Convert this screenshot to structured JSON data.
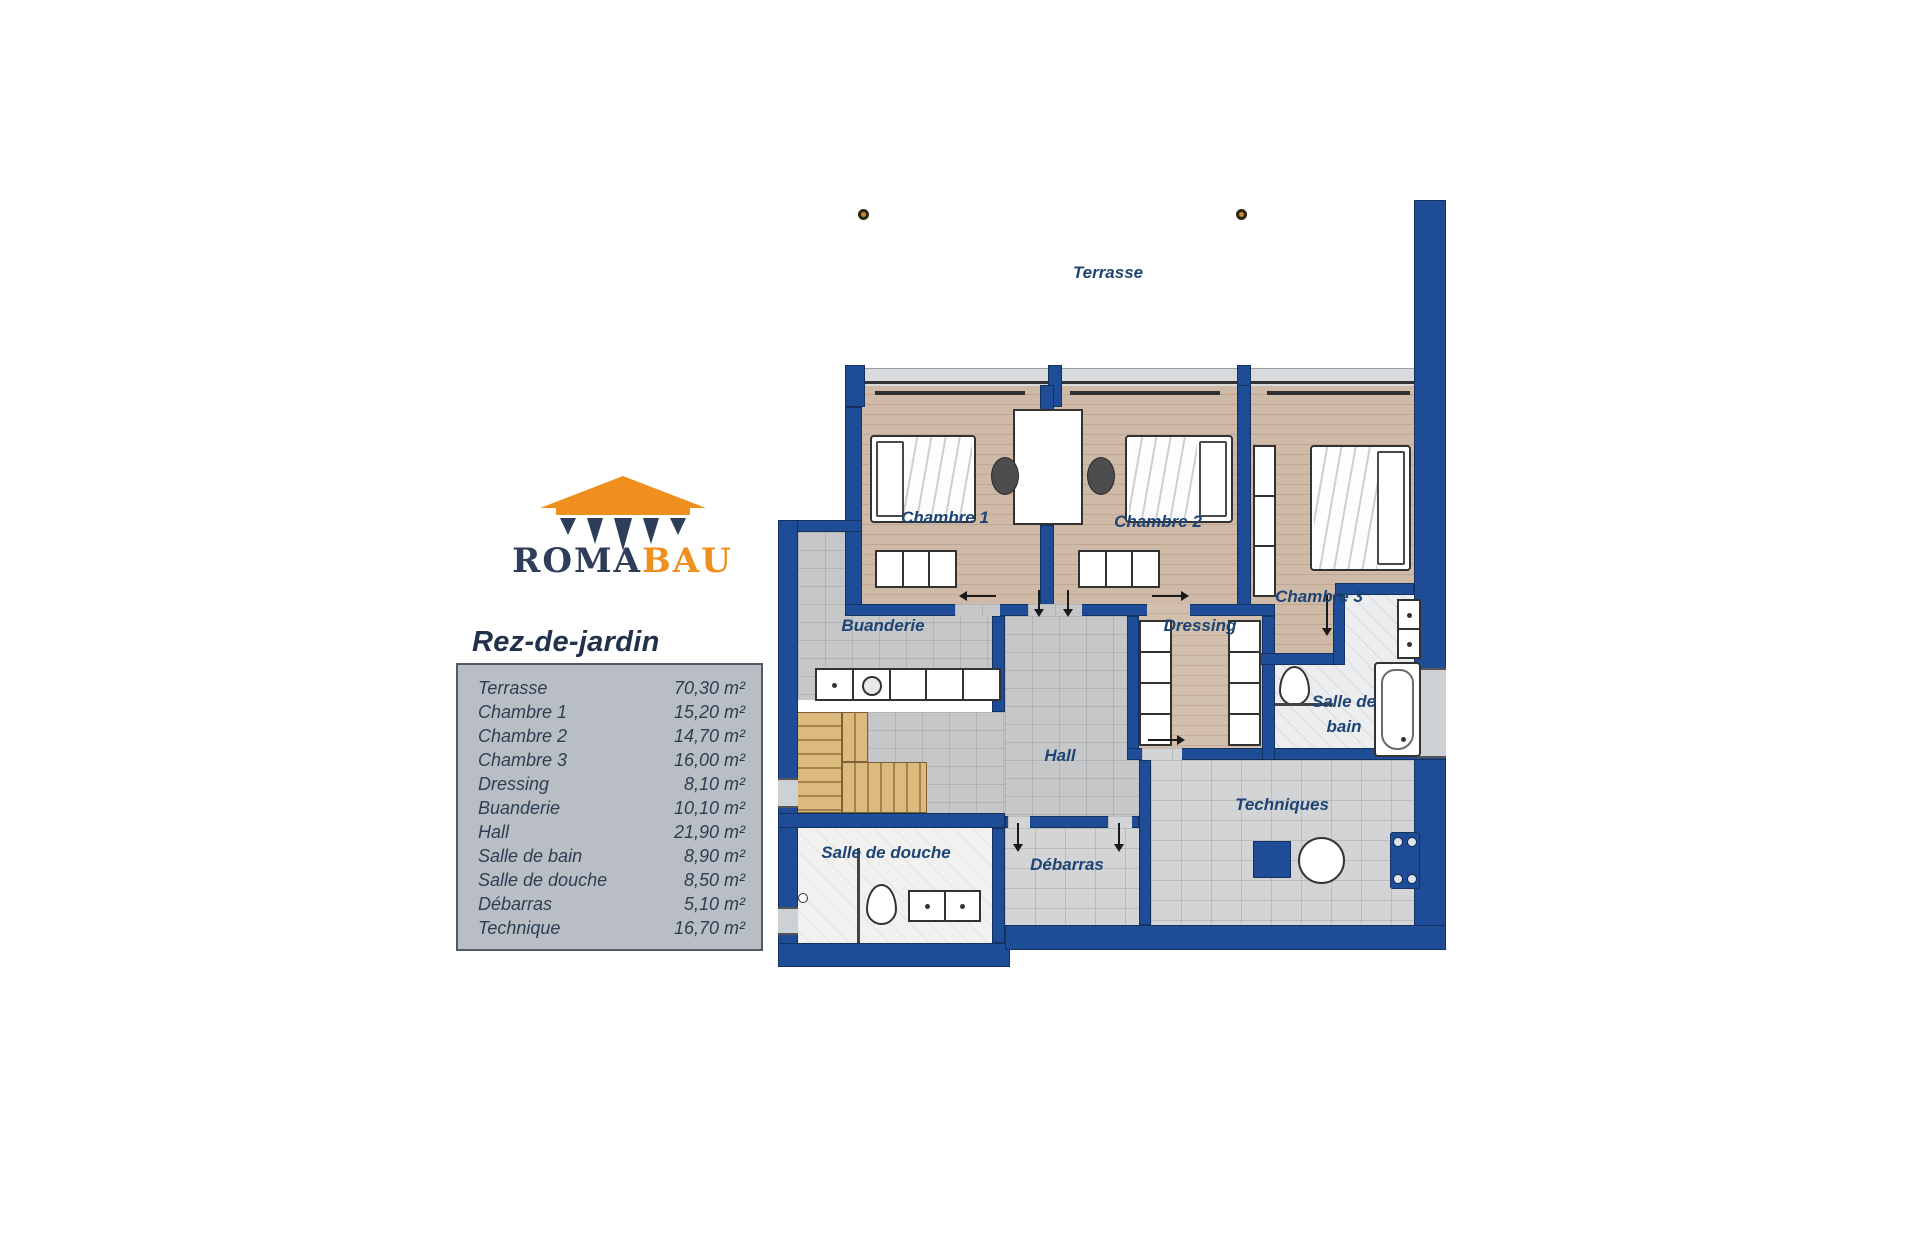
{
  "logo": {
    "text_primary": "ROMA",
    "text_secondary": "BAU",
    "icon": "temple-roof-icon",
    "colors": {
      "primary_navy": "#2e3d59",
      "secondary_orange": "#ef8f1d"
    }
  },
  "plan_title": "Rez-de-jardin",
  "legend": {
    "rows": [
      {
        "label": "Terrasse",
        "area": "70,30 m²"
      },
      {
        "label": "Chambre 1",
        "area": "15,20 m²"
      },
      {
        "label": "Chambre 2",
        "area": "14,70 m²"
      },
      {
        "label": "Chambre 3",
        "area": "16,00 m²"
      },
      {
        "label": "Dressing",
        "area": "8,10 m²"
      },
      {
        "label": "Buanderie",
        "area": "10,10 m²"
      },
      {
        "label": "Hall",
        "area": "21,90 m²"
      },
      {
        "label": "Salle de bain",
        "area": "8,90 m²"
      },
      {
        "label": "Salle de douche",
        "area": "8,50 m²"
      },
      {
        "label": "Débarras",
        "area": "5,10 m²"
      },
      {
        "label": "Technique",
        "area": "16,70 m²"
      }
    ]
  },
  "floorplan": {
    "labels": {
      "terrasse": "Terrasse",
      "chambre1": "Chambre 1",
      "chambre2": "Chambre 2",
      "chambre3": "Chambre 3",
      "buanderie": "Buanderie",
      "dressing": "Dressing",
      "hall": "Hall",
      "salle_de_bain_line1": "Salle de",
      "salle_de_bain_line2": "bain",
      "salle_de_douche": "Salle de douche",
      "debarras": "Débarras",
      "techniques": "Techniques"
    },
    "colors": {
      "wall_navy": "#1e4c96",
      "wood_floor": "#cfbaa8",
      "tile_gray": "#c6c7c9",
      "stone_gray": "#d3d4d6",
      "bath_floor": "#ecedee",
      "stairs_wood": "#dcba7d",
      "label_text": "#1d4474"
    }
  }
}
